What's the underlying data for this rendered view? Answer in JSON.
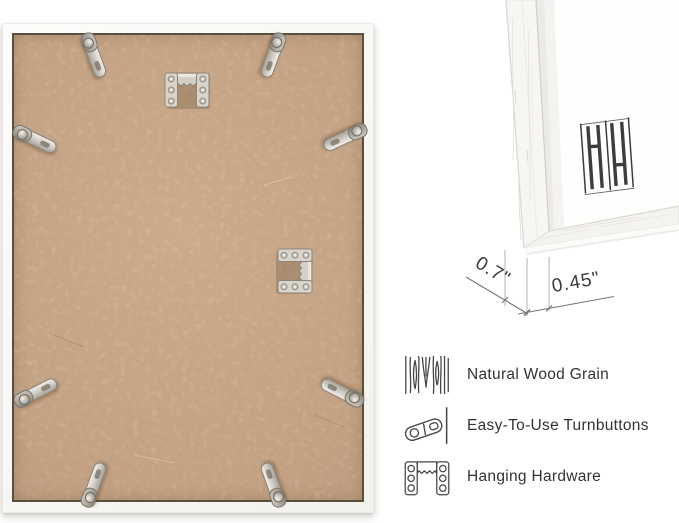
{
  "image_title": "Picture frame back with hardware, corner close-up, dimensions and feature callouts",
  "brand": {
    "logo_monogram": "HH"
  },
  "dimensions": {
    "depth_label": "0.7\"",
    "face_width_label": "0.45\""
  },
  "features": [
    {
      "icon": "wood-grain-icon",
      "label": "Natural Wood Grain"
    },
    {
      "icon": "turnbutton-icon",
      "label": "Easy-To-Use Turnbuttons"
    },
    {
      "icon": "hanging-hardware-icon",
      "label": "Hanging Hardware"
    }
  ],
  "hardware": {
    "turnbutton_count": 8,
    "hanging_bracket_count": 2
  },
  "colors": {
    "background": "#ffffff",
    "mdf_board": "#c3a183",
    "board_edge_line": "#57503f",
    "frame_white": "#fbfaf7",
    "metal": "#d6d2ca",
    "dimension_line": "#77756f",
    "label_text": "#333333"
  }
}
